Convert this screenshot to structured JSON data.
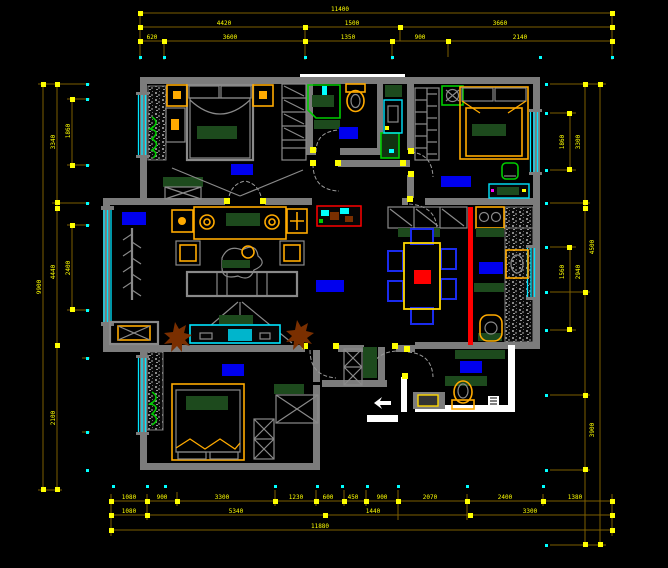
{
  "canvas": {
    "width": 668,
    "height": 568,
    "type": "cad-floor-plan"
  },
  "colors": {
    "bg": "#000000",
    "wall": "#7c7c7c",
    "wall_white": "#ffffff",
    "dim": "#7d5e00",
    "dim_text": "#ffff00",
    "marker": "#00ffff",
    "window": "#00e5ff",
    "furniture": "#ffaa00",
    "furniture_alt": "#ffd700",
    "green_dark": "#1d4a1d",
    "green": "#00cc00",
    "rug": "#0000ee",
    "chair": "#1a2bee",
    "red": "#ff0000",
    "brown": "#7a2f00",
    "gray": "#8a8a8a",
    "arc": "#9a9a9a"
  },
  "dims": {
    "top": [
      "11400",
      "4420",
      "1500",
      "3660",
      "620",
      "3600",
      "1350",
      "900",
      "2140"
    ],
    "bottom": [
      "1080",
      "900",
      "3300",
      "1230",
      "600",
      "450",
      "900",
      "2070",
      "2400",
      "1380",
      "1080",
      "5340",
      "1440",
      "3300",
      "11880"
    ],
    "left": [
      "9900",
      "3340",
      "4440",
      "2100",
      "1860",
      "2400"
    ],
    "right": [
      "1860",
      "3300",
      "4500",
      "1560",
      "2940",
      "3900"
    ]
  }
}
